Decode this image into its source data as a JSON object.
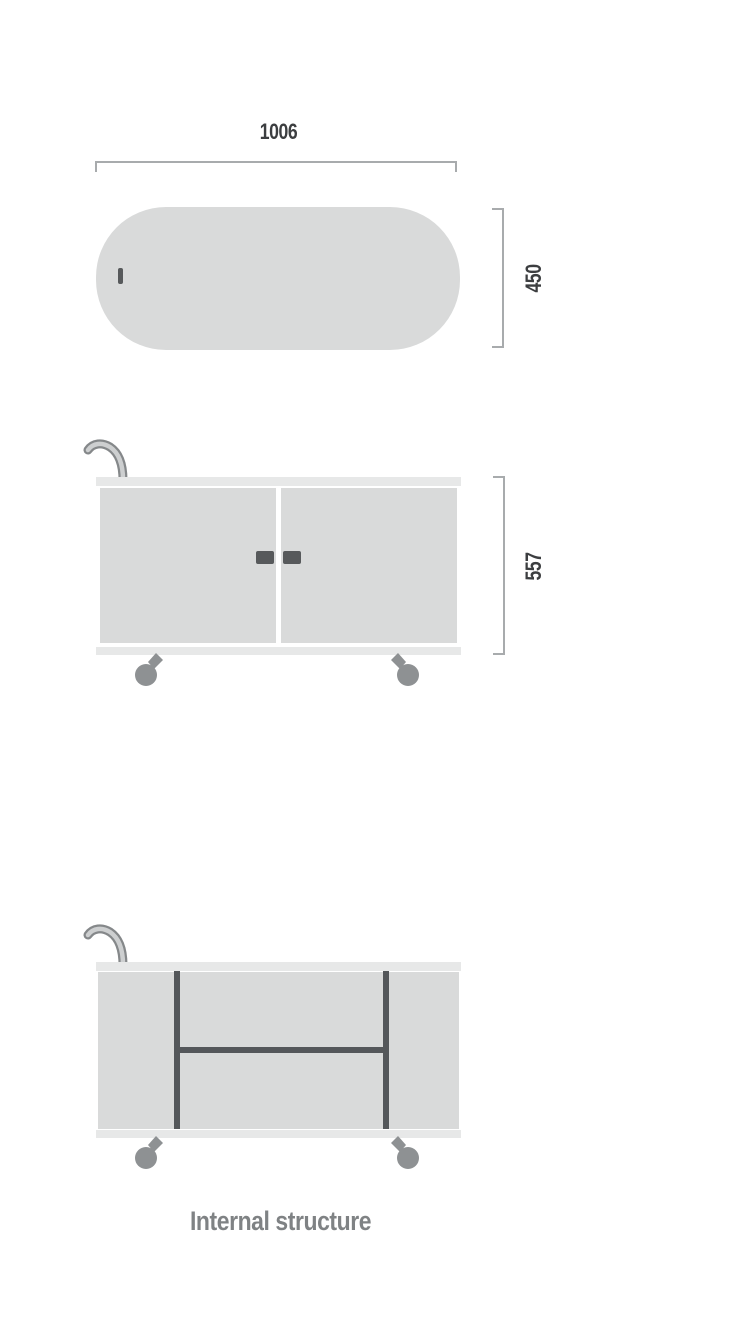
{
  "diagram": {
    "type": "furniture-dimension-drawing",
    "subject": "two-door trolley cabinet with casters and hook handle",
    "views": {
      "top_view": {
        "name": "Top view",
        "width_dim": "1006",
        "depth_dim": "450"
      },
      "front_view": {
        "name": "Front view",
        "height_dim": "557"
      },
      "internal_view": {
        "name": "Internal structure view",
        "caption": "Internal structure"
      }
    },
    "colors": {
      "panel_gray": "#d9dada",
      "strip_gray": "#e7e8e8",
      "dark_part": "#57595b",
      "caster_gray": "#8e9193",
      "internal_bar": "#54575a",
      "dimension_text": "#3c3e40",
      "bracket_line": "#a8abad",
      "caption_text": "#7f8284",
      "background": "#ffffff"
    }
  }
}
